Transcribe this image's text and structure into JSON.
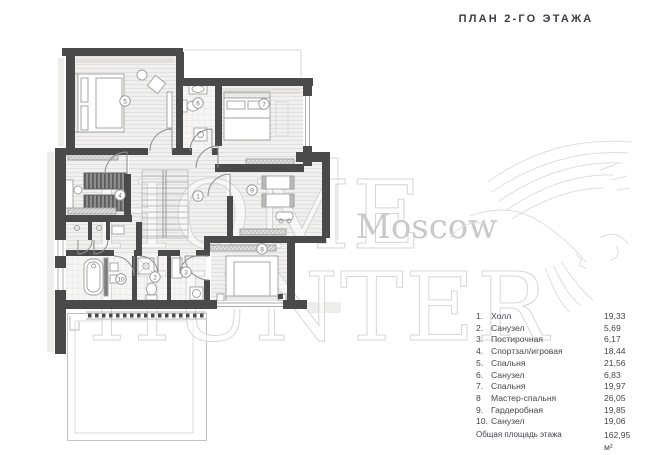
{
  "title": "ПЛАН 2-ГО ЭТАЖА",
  "watermark": {
    "line1": "HOME",
    "line2": "HUNTER",
    "city": "Moscow"
  },
  "legend": {
    "items": [
      {
        "num": "1.",
        "name": "Холл",
        "area": "19,33"
      },
      {
        "num": "2.",
        "name": "Санузел",
        "area": "5,69"
      },
      {
        "num": "3.",
        "name": "Постирочная",
        "area": "6,17"
      },
      {
        "num": "4.",
        "name": "Спортзал/игровая",
        "area": "18,44"
      },
      {
        "num": "5.",
        "name": "Спальня",
        "area": "21,56"
      },
      {
        "num": "6.",
        "name": "Санузел",
        "area": "6,83"
      },
      {
        "num": "7.",
        "name": "Спальня",
        "area": "19,97"
      },
      {
        "num": "8",
        "name": "Мастер-спальня",
        "area": "26,05"
      },
      {
        "num": "9.",
        "name": "Гардеробная",
        "area": "19,85"
      },
      {
        "num": "10.",
        "name": "Санузел",
        "area": "19,06"
      }
    ],
    "total_label": "Общая площадь этажа",
    "total_value": "162,95 м²"
  },
  "plan": {
    "markers": [
      {
        "label": "1"
      },
      {
        "label": "2"
      },
      {
        "label": "3"
      },
      {
        "label": "4"
      },
      {
        "label": "5"
      },
      {
        "label": "6"
      },
      {
        "label": "7"
      },
      {
        "label": "8"
      },
      {
        "label": "9"
      },
      {
        "label": "10"
      }
    ]
  },
  "colors": {
    "wall": "#4a4a4a",
    "text": "#45454d",
    "watermark": "#d2d2d2"
  }
}
